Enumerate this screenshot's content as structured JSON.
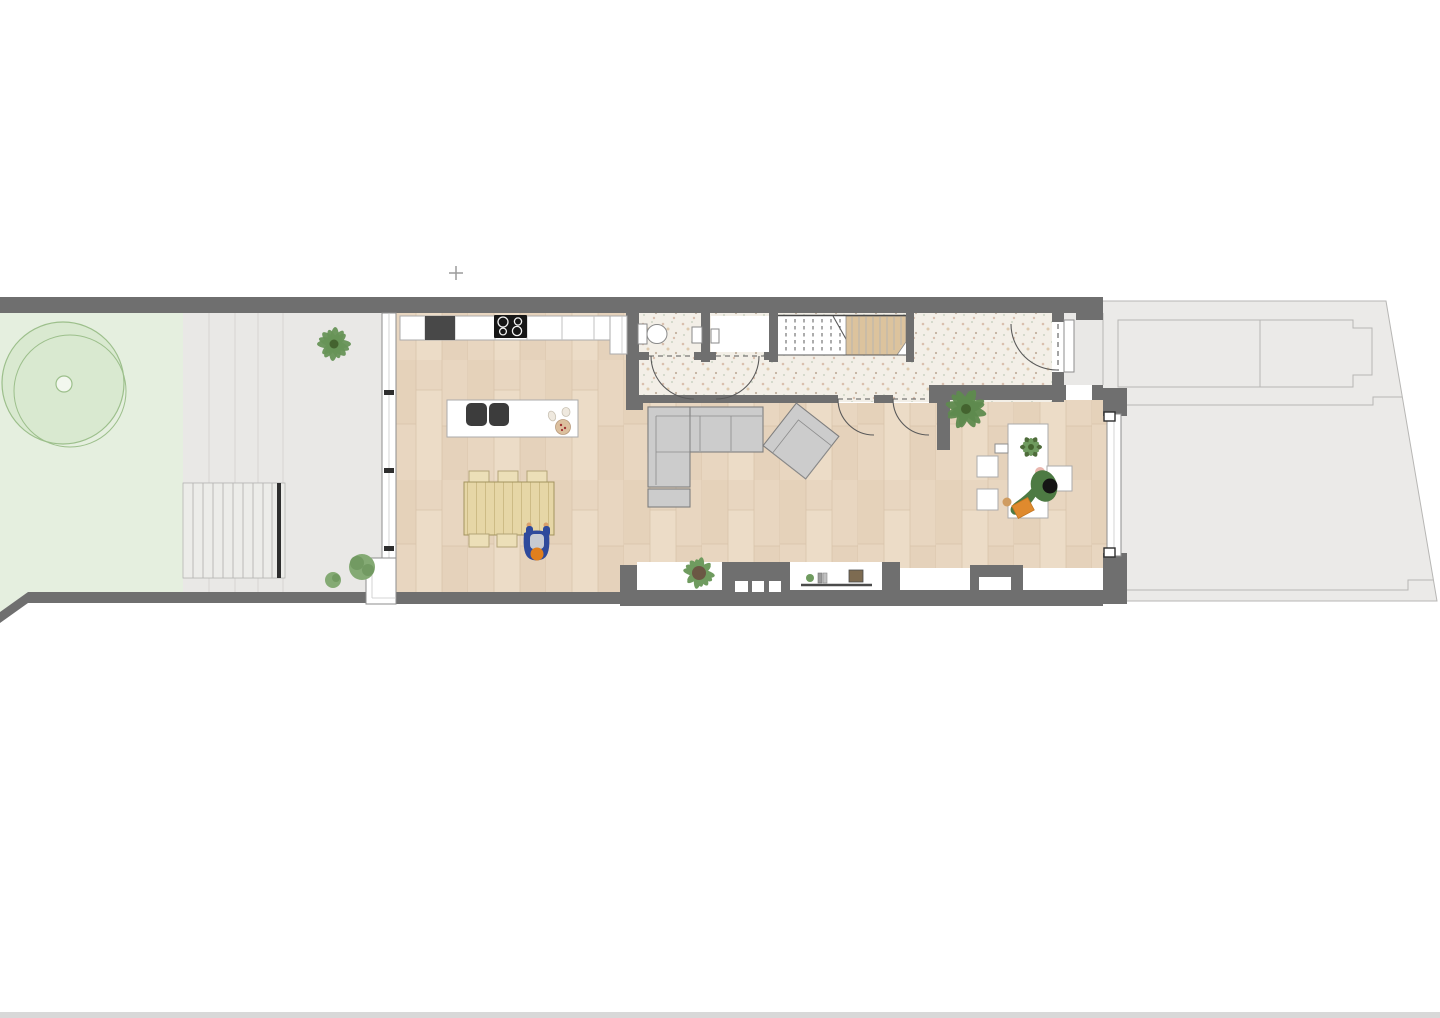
{
  "document": {
    "type": "architectural-floor-plan",
    "view": "ground-floor-top-down",
    "visible_text": [],
    "cursor_glyph": "+"
  },
  "colors": {
    "page": "#ffffff",
    "wall": "#6f6f6f",
    "white": "#ffffff",
    "garden": "#e5efdf",
    "tree_stroke": "#9cbf8b",
    "tree_fill": "#cfe3c2",
    "tree_core": "#f2f7ee",
    "terrace": "#e9e8e6",
    "steps": "#ecece9",
    "step_edge": "#2e2e2e",
    "paver_line": "#d6d5d3",
    "tread_line": "#b5b4b2",
    "yard": "#ebeae8",
    "yard_line": "#b7b6b4",
    "wood_base": "#e8d6c0",
    "wood_line": "#d8c2a8",
    "wood_shade1": "#e2cdb4",
    "wood_shade2": "#eedfcb",
    "terrazzo_base": "#f3efe7",
    "terrazzo_dot1": "#d9bfae",
    "terrazzo_dot2": "#ccd4c4",
    "terrazzo_dot3": "#dec9ae",
    "terrazzo_dot4": "#c2b19e",
    "stair_wood": "#dcc39d",
    "stair_edge": "#4a4a4a",
    "frame_stroke": "#8e8e8e",
    "inner_line": "#c9c9c9",
    "joint_line": "#c2c2c2",
    "counter_stroke": "#ababab",
    "appliance_dark": "#484848",
    "cooktop_black": "#161616",
    "island_sink": "#3c3c3c",
    "plate_tan": "#dcc09e",
    "plate_dots": "#a23333",
    "table_wood": "#e6d6a6",
    "table_line": "#cdbb85",
    "table_stroke": "#a3945f",
    "chair_wood": "#ecdfb8",
    "chair_stroke": "#b3a478",
    "sofa_fill": "#cccccc",
    "sofa_stroke": "#7f7f7f",
    "sofa_inner": "#8c8c8c",
    "door_line": "#5a5a5a",
    "fixture_stroke": "#8a8a8a",
    "plant_green": "#6f9b5f",
    "plant_dark": "#44632f",
    "pot_brown": "#6b5744",
    "box_brown": "#7d6b51",
    "shelf_dark": "#4a4a4a",
    "person1_body": "#2e4a9c",
    "person1_shirt": "#c6cad2",
    "person1_head": "#e07f1e",
    "person1_hand": "#d9a06b",
    "person2_body": "#4d7a43",
    "person2_hair": "#151515",
    "person2_hand": "#e9b6ae",
    "notebook_orange": "#df8a2e",
    "tan_cup": "#cf9c61",
    "cursor_gray": "#9b9b9b",
    "bottom_bar": "#d8d8d8"
  },
  "legend": {
    "rooms": [
      "garden",
      "terrace",
      "kitchen-dining",
      "hallway",
      "wc",
      "storage-closet",
      "staircase",
      "living-room",
      "home-office",
      "entry-porch",
      "front-yard"
    ],
    "furniture": [
      "kitchen-counter",
      "tall-appliance",
      "cooktop",
      "kitchen-island",
      "double-sink",
      "dining-table",
      "dining-chairs",
      "corner-sofa",
      "ottoman",
      "armchair",
      "window-sill-console",
      "desk",
      "desk-chairs",
      "toilet",
      "hand-basin"
    ],
    "people": [
      "person-at-dining-table",
      "person-at-desk"
    ],
    "plants": [
      "garden-tree",
      "terrace-plant",
      "terrace-bushes",
      "sill-plant",
      "console-plant",
      "office-corner-plant",
      "desk-plant"
    ]
  }
}
